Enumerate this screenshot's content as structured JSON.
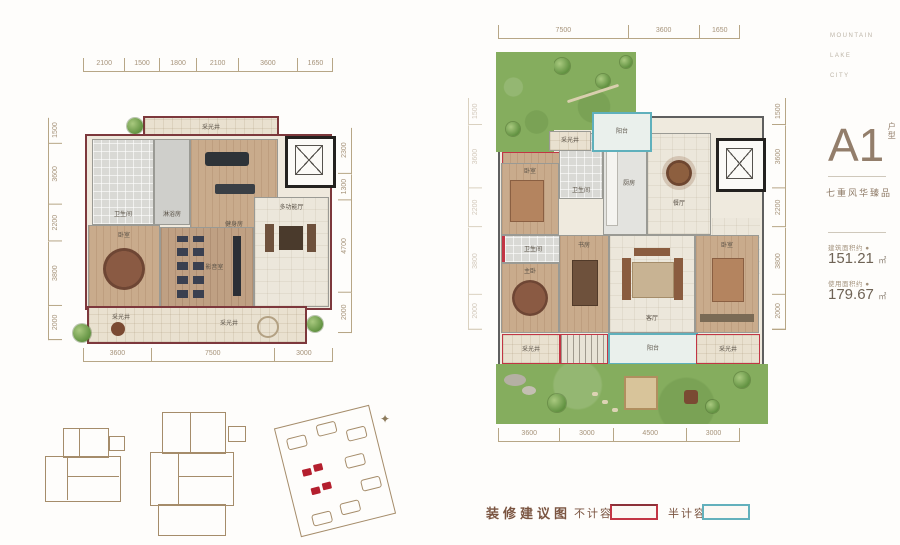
{
  "brand": {
    "line1": "MOUNTAIN",
    "line2": "LAKE",
    "line3": "CITY"
  },
  "unit": {
    "name": "A1",
    "type_label": "户型",
    "tagline": "七重风华臻品",
    "area1_label": "建筑面积约 ●",
    "area1_value": "151.21",
    "area2_label": "使用面积约 ●",
    "area2_value": "179.67",
    "area_unit": "㎡"
  },
  "legend": {
    "title": "装修建议图",
    "not_counted": "不计容",
    "half_counted": "半计容"
  },
  "icons": {
    "compass": "✦"
  },
  "left_plan": {
    "dims_top": [
      2100,
      1500,
      1800,
      2100,
      3600,
      1650
    ],
    "dims_left": [
      1500,
      3600,
      2200,
      3800,
      2000
    ],
    "dims_right": [
      2300,
      1300,
      4700,
      2000
    ],
    "dims_bottom": [
      3600,
      7500,
      3000
    ],
    "rooms": {
      "skylight_top": "采光井",
      "bath": "卫生间",
      "shower": "淋浴房",
      "gym": "健身房",
      "multi_hall": "多功能厅",
      "bedroom": "卧室",
      "cinema": "影音室",
      "skylight_bl": "采光井",
      "skylight_bc": "采光井"
    }
  },
  "right_plan": {
    "dims_top": [
      7500,
      3600,
      1650
    ],
    "dims_side": [
      1500,
      3600,
      2200,
      3800,
      2000
    ],
    "dims_bottom": [
      3600,
      3000,
      4500,
      3000
    ],
    "rooms": {
      "skylight_top": "采光井",
      "balcony_top": "阳台",
      "bedroom1": "卧室",
      "bath1": "卫生间",
      "kitchen": "厨房",
      "dining": "餐厅",
      "entry": "玄关",
      "bath2": "卫生间",
      "master": "主卧",
      "study": "书房",
      "living": "客厅",
      "bedroom2": "卧室",
      "skylight_bl": "采光井",
      "balcony_bottom": "阳台",
      "skylight_br": "采光井"
    }
  }
}
